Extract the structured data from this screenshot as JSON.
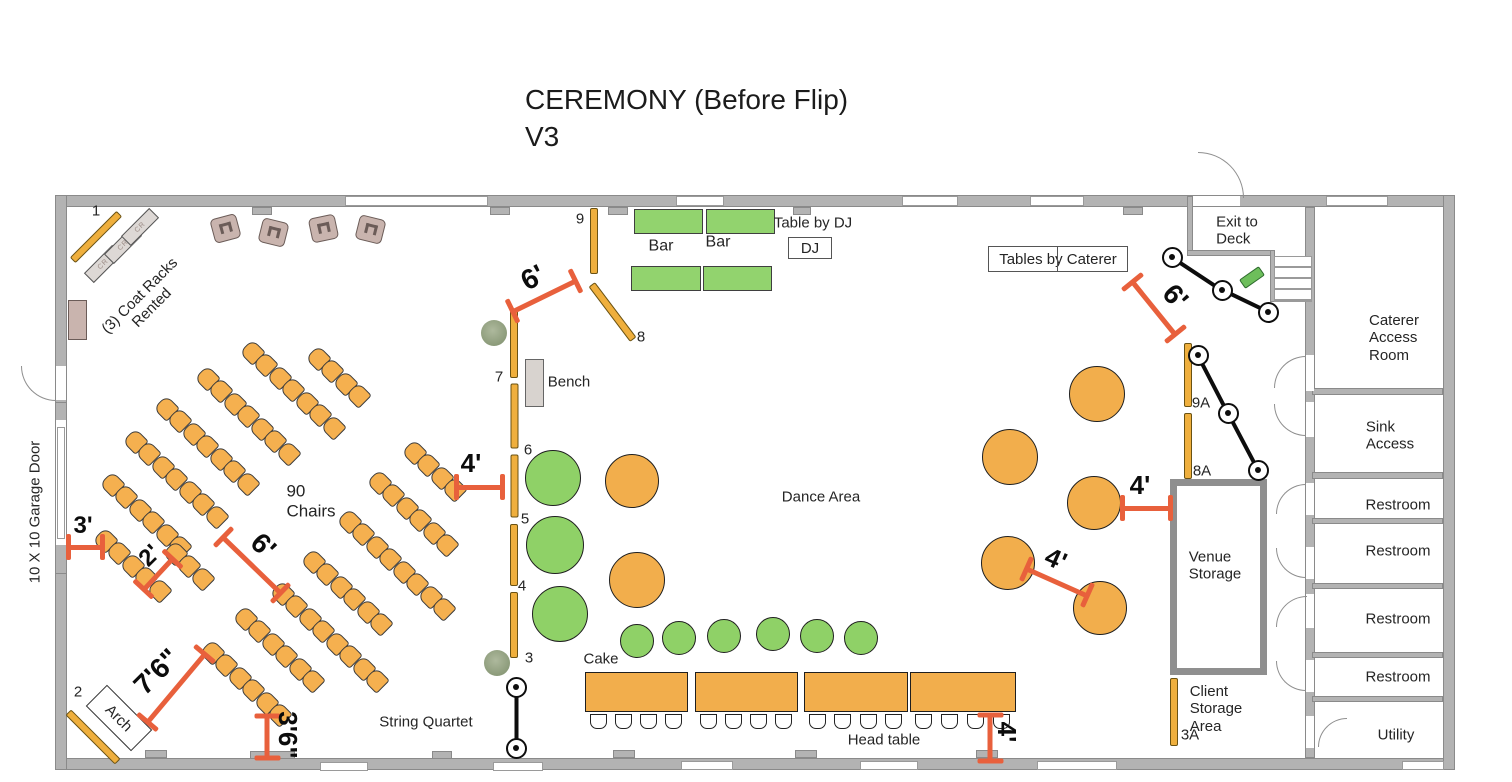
{
  "title": {
    "line1": "CEREMONY (Before Flip)",
    "line2": "V3"
  },
  "colors": {
    "dimension": "#E8603C",
    "chair": "#F5B04F",
    "table_orange": "#F2AE4C",
    "table_green": "#8FD167",
    "bar_green": "#92D36E",
    "gold_bar": "#EFAF3D",
    "wall": "#B3B3B3",
    "lounge": "#C9B4AE"
  },
  "building": {
    "walls": [
      [
        55,
        195,
        1400,
        12
      ],
      [
        55,
        758,
        1400,
        12
      ],
      [
        55,
        195,
        12,
        575
      ],
      [
        1443,
        195,
        12,
        575
      ],
      [
        1305,
        207,
        10,
        551
      ],
      [
        1312,
        388,
        131,
        7
      ],
      [
        1312,
        472,
        131,
        7
      ],
      [
        1312,
        518,
        131,
        6
      ],
      [
        1312,
        583,
        131,
        6
      ],
      [
        1312,
        652,
        131,
        6
      ],
      [
        1312,
        696,
        131,
        6
      ],
      [
        1187,
        196,
        6,
        60
      ],
      [
        1187,
        250,
        86,
        6
      ],
      [
        1270,
        250,
        5,
        52
      ]
    ],
    "gaps": [
      [
        1306,
        355,
        8,
        36
      ],
      [
        1306,
        402,
        8,
        35
      ],
      [
        1306,
        483,
        8,
        32
      ],
      [
        1306,
        547,
        8,
        32
      ],
      [
        1306,
        594,
        8,
        34
      ],
      [
        1306,
        660,
        8,
        32
      ],
      [
        1306,
        716,
        8,
        32
      ],
      [
        1193,
        196,
        47,
        10
      ],
      [
        56,
        366,
        10,
        34
      ],
      [
        56,
        420,
        10,
        125
      ]
    ],
    "pilasters": [
      [
        252,
        207,
        20,
        8
      ],
      [
        490,
        207,
        20,
        8
      ],
      [
        608,
        207,
        20,
        8
      ],
      [
        793,
        207,
        18,
        8
      ],
      [
        1123,
        207,
        20,
        8
      ],
      [
        145,
        750,
        22,
        8
      ],
      [
        432,
        751,
        20,
        8
      ],
      [
        613,
        750,
        22,
        8
      ],
      [
        795,
        750,
        22,
        8
      ],
      [
        976,
        750,
        22,
        8
      ],
      [
        250,
        751,
        45,
        8
      ],
      [
        55,
        402,
        12,
        22
      ],
      [
        55,
        540,
        12,
        34
      ]
    ],
    "windows": [
      [
        345,
        196,
        143,
        10
      ],
      [
        676,
        196,
        48,
        10
      ],
      [
        902,
        196,
        56,
        10
      ],
      [
        1030,
        196,
        54,
        10
      ],
      [
        1326,
        196,
        62,
        10
      ],
      [
        320,
        762,
        48,
        9
      ],
      [
        493,
        762,
        50,
        9
      ],
      [
        681,
        761,
        52,
        9
      ],
      [
        860,
        761,
        58,
        9
      ],
      [
        1037,
        761,
        80,
        9
      ],
      [
        1402,
        761,
        42,
        9
      ],
      [
        57,
        427,
        8,
        112
      ]
    ],
    "door_arcs": [
      {
        "x": 1274,
        "y": 356,
        "r": 32,
        "c": "tl"
      },
      {
        "x": 1274,
        "y": 404,
        "r": 32,
        "c": "bl"
      },
      {
        "x": 1276,
        "y": 484,
        "r": 30,
        "c": "tl"
      },
      {
        "x": 1276,
        "y": 548,
        "r": 30,
        "c": "bl"
      },
      {
        "x": 1276,
        "y": 596,
        "r": 31,
        "c": "tl"
      },
      {
        "x": 1276,
        "y": 661,
        "r": 30,
        "c": "bl"
      },
      {
        "x": 1318,
        "y": 718,
        "r": 29,
        "c": "tl"
      },
      {
        "x": 21,
        "y": 366,
        "r": 35,
        "c": "bl"
      },
      {
        "x": 1198,
        "y": 152,
        "r": 46,
        "c": "tr"
      }
    ],
    "stairs": {
      "x": 1274,
      "y": 256,
      "w": 38,
      "h": 46
    }
  },
  "furniture": {
    "green_tables": [
      [
        634,
        209,
        69,
        25
      ],
      [
        706,
        209,
        69,
        25
      ],
      [
        631,
        266,
        70,
        25
      ],
      [
        703,
        266,
        69,
        25
      ]
    ],
    "bench_rect": [
      525,
      359,
      19,
      48
    ],
    "side_table": [
      68,
      300,
      19,
      40
    ],
    "venue_storage_rect": [
      1170,
      479,
      97,
      196
    ],
    "dj_box": {
      "x": 788,
      "y": 237,
      "w": 44,
      "h": 22,
      "label": "DJ"
    },
    "caterer_box": {
      "x": 988,
      "y": 246,
      "w": 140,
      "h": 26,
      "label": "Tables by Caterer"
    },
    "arch_box": {
      "cx": 119,
      "cy": 718,
      "w": 64,
      "h": 30,
      "rot": 45,
      "label": "Arch"
    },
    "lounge_chairs": [
      [
        225,
        228,
        -15
      ],
      [
        273,
        232,
        14
      ],
      [
        323,
        228,
        -12
      ],
      [
        370,
        229,
        14
      ]
    ],
    "coat_racks": [
      [
        103,
        264
      ],
      [
        123,
        245
      ],
      [
        140,
        227
      ]
    ],
    "coat_rack_label": "CR",
    "plants": [
      [
        494,
        333
      ],
      [
        497,
        663
      ]
    ],
    "deck_item": [
      1252,
      277,
      -35
    ],
    "round_green_large": [
      [
        553,
        478,
        28
      ],
      [
        555,
        545,
        29
      ],
      [
        560,
        614,
        28
      ]
    ],
    "round_orange_mid": [
      [
        632,
        481,
        27
      ],
      [
        637,
        580,
        28
      ]
    ],
    "round_orange_right": [
      [
        1097,
        394,
        28
      ],
      [
        1010,
        457,
        28
      ],
      [
        1094,
        503,
        27
      ],
      [
        1008,
        563,
        27
      ],
      [
        1100,
        608,
        27
      ]
    ],
    "round_green_small": [
      [
        637,
        641,
        17
      ],
      [
        679,
        638,
        17
      ],
      [
        724,
        636,
        17
      ],
      [
        773,
        634,
        17
      ],
      [
        817,
        636,
        17
      ],
      [
        861,
        638,
        17
      ]
    ],
    "head_tables": [
      [
        585,
        672,
        103,
        40
      ],
      [
        695,
        672,
        103,
        40
      ],
      [
        804,
        672,
        104,
        40
      ],
      [
        910,
        672,
        106,
        40
      ]
    ],
    "stanchions": [
      [
        [
          1172,
          257
        ],
        [
          1222,
          290
        ],
        [
          1268,
          312
        ]
      ],
      [
        [
          1198,
          355
        ],
        [
          1228,
          413
        ],
        [
          1258,
          470
        ]
      ],
      [
        [
          516,
          687
        ],
        [
          516,
          748
        ]
      ]
    ],
    "chair_rows": [
      [
        252,
        352,
        7
      ],
      [
        318,
        358,
        4
      ],
      [
        207,
        378,
        7
      ],
      [
        166,
        408,
        7
      ],
      [
        135,
        441,
        7
      ],
      [
        112,
        484,
        6
      ],
      [
        105,
        540,
        5
      ],
      [
        175,
        553,
        3
      ],
      [
        245,
        618,
        6
      ],
      [
        212,
        652,
        6
      ],
      [
        282,
        593,
        8
      ],
      [
        313,
        561,
        6
      ],
      [
        349,
        521,
        8
      ],
      [
        379,
        482,
        6
      ],
      [
        414,
        452,
        4
      ]
    ],
    "gold_bars": [
      {
        "cx": 96,
        "cy": 237,
        "len": 66,
        "rot": -45
      },
      {
        "cx": 93,
        "cy": 737,
        "len": 70,
        "rot": 45
      },
      {
        "cx": 594,
        "cy": 241,
        "len": 66,
        "rot": 90
      },
      {
        "cx": 612,
        "cy": 312,
        "len": 69,
        "rot": 53
      },
      {
        "cx": 514,
        "cy": 344,
        "len": 68,
        "rot": 90
      },
      {
        "cx": 514,
        "cy": 416,
        "len": 65,
        "rot": 90
      },
      {
        "cx": 514,
        "cy": 486,
        "len": 63,
        "rot": 90
      },
      {
        "cx": 514,
        "cy": 555,
        "len": 62,
        "rot": 90
      },
      {
        "cx": 514,
        "cy": 625,
        "len": 66,
        "rot": 90
      },
      {
        "cx": 1188,
        "cy": 375,
        "len": 64,
        "rot": 90
      },
      {
        "cx": 1188,
        "cy": 446,
        "len": 66,
        "rot": 90
      },
      {
        "cx": 1174,
        "cy": 712,
        "len": 68,
        "rot": 90
      }
    ]
  },
  "dimensions": [
    {
      "n": "dim-3ft",
      "t": "3'",
      "cx": 85,
      "cy": 547,
      "len": 34,
      "rot": 0,
      "lx": 83,
      "ly": 526,
      "lrot": 0,
      "ls": 24
    },
    {
      "n": "dim-2ft",
      "t": "2'",
      "cx": 158,
      "cy": 574,
      "len": 42,
      "rot": -47,
      "lx": 150,
      "ly": 556,
      "lrot": -45,
      "ls": 24
    },
    {
      "n": "dim-6ft-aisle",
      "t": "6'",
      "cx": 252,
      "cy": 565,
      "len": 80,
      "rot": 44,
      "lx": 263,
      "ly": 546,
      "lrot": 44,
      "ls": 28
    },
    {
      "n": "dim-7ft6",
      "t": "7'6\"",
      "cx": 176,
      "cy": 688,
      "len": 88,
      "rot": -50,
      "lx": 157,
      "ly": 672,
      "lrot": -45,
      "ls": 28
    },
    {
      "n": "dim-3ft6",
      "t": "3'6\"",
      "cx": 267,
      "cy": 737,
      "len": 42,
      "rot": 90,
      "lx": 288,
      "ly": 735,
      "lrot": 90,
      "ls": 26
    },
    {
      "n": "dim-4ft-chairs",
      "t": "4'",
      "cx": 479,
      "cy": 487,
      "len": 46,
      "rot": 0,
      "lx": 471,
      "ly": 463,
      "lrot": 0,
      "ls": 26
    },
    {
      "n": "dim-6ft-bars",
      "t": "6'",
      "cx": 544,
      "cy": 296,
      "len": 70,
      "rot": -26,
      "lx": 533,
      "ly": 278,
      "lrot": -28,
      "ls": 28
    },
    {
      "n": "dim-6ft-deck",
      "t": "6'",
      "cx": 1154,
      "cy": 308,
      "len": 68,
      "rot": 51,
      "lx": 1175,
      "ly": 297,
      "lrot": 48,
      "ls": 28
    },
    {
      "n": "dim-4ft-storage",
      "t": "4'",
      "cx": 1146,
      "cy": 508,
      "len": 48,
      "rot": 0,
      "lx": 1140,
      "ly": 485,
      "lrot": 0,
      "ls": 26
    },
    {
      "n": "dim-4ft-tables",
      "t": "4'",
      "cx": 1057,
      "cy": 582,
      "len": 66,
      "rot": 24,
      "lx": 1056,
      "ly": 559,
      "lrot": 24,
      "ls": 26
    },
    {
      "n": "dim-4ft-headtable",
      "t": "4'",
      "cx": 990,
      "cy": 738,
      "len": 46,
      "rot": 90,
      "lx": 1007,
      "ly": 732,
      "lrot": 90,
      "ls": 26
    }
  ],
  "labels": [
    {
      "n": "marker-1",
      "t": "1",
      "x": 96,
      "y": 211,
      "s": 15
    },
    {
      "n": "marker-2",
      "t": "2",
      "x": 78,
      "y": 692,
      "s": 15
    },
    {
      "n": "marker-9",
      "t": "9",
      "x": 580,
      "y": 219,
      "s": 15
    },
    {
      "n": "marker-8",
      "t": "8",
      "x": 641,
      "y": 337,
      "s": 15
    },
    {
      "n": "marker-7",
      "t": "7",
      "x": 499,
      "y": 377,
      "s": 15
    },
    {
      "n": "marker-6",
      "t": "6",
      "x": 528,
      "y": 450,
      "s": 15
    },
    {
      "n": "marker-5",
      "t": "5",
      "x": 525,
      "y": 519,
      "s": 15
    },
    {
      "n": "marker-4",
      "t": "4",
      "x": 522,
      "y": 586,
      "s": 15
    },
    {
      "n": "marker-3",
      "t": "3",
      "x": 529,
      "y": 658,
      "s": 15
    },
    {
      "n": "marker-9a",
      "t": "9A",
      "x": 1201,
      "y": 403,
      "s": 15
    },
    {
      "n": "marker-8a",
      "t": "8A",
      "x": 1202,
      "y": 471,
      "s": 15
    },
    {
      "n": "marker-3a",
      "t": "3A",
      "x": 1190,
      "y": 735,
      "s": 15
    },
    {
      "n": "coat-racks-note",
      "t": "(3) Coat Racks\nRented",
      "x": 146,
      "y": 302,
      "s": 15,
      "rot": -45
    },
    {
      "n": "bar-label-1",
      "t": "Bar",
      "x": 661,
      "y": 247,
      "s": 16
    },
    {
      "n": "bar-label-2",
      "t": "Bar",
      "x": 718,
      "y": 243,
      "s": 16
    },
    {
      "n": "table-by-dj-label",
      "t": "Table by DJ",
      "x": 813,
      "y": 223,
      "s": 15
    },
    {
      "n": "exit-to-deck-label",
      "t": "Exit to\nDeck",
      "x": 1237,
      "y": 231,
      "s": 15,
      "align": "left"
    },
    {
      "n": "caterer-access-room-label",
      "t": "Caterer\nAccess\nRoom",
      "x": 1394,
      "y": 338,
      "s": 15,
      "align": "left"
    },
    {
      "n": "sink-access-label",
      "t": "Sink\nAccess",
      "x": 1390,
      "y": 436,
      "s": 15,
      "align": "left"
    },
    {
      "n": "restroom-label-1",
      "t": "Restroom",
      "x": 1398,
      "y": 505,
      "s": 15
    },
    {
      "n": "restroom-label-2",
      "t": "Restroom",
      "x": 1398,
      "y": 551,
      "s": 15
    },
    {
      "n": "restroom-label-3",
      "t": "Restroom",
      "x": 1398,
      "y": 619,
      "s": 15
    },
    {
      "n": "restroom-label-4",
      "t": "Restroom",
      "x": 1398,
      "y": 677,
      "s": 15
    },
    {
      "n": "utility-label",
      "t": "Utility",
      "x": 1396,
      "y": 735,
      "s": 15
    },
    {
      "n": "venue-storage-label",
      "t": "Venue\nStorage",
      "x": 1215,
      "y": 566,
      "s": 15,
      "align": "left"
    },
    {
      "n": "client-storage-label",
      "t": "Client\nStorage\nArea",
      "x": 1216,
      "y": 709,
      "s": 15,
      "align": "left"
    },
    {
      "n": "dance-area-label",
      "t": "Dance Area",
      "x": 821,
      "y": 497,
      "s": 15
    },
    {
      "n": "chair-count-label",
      "t": "90\nChairs",
      "x": 311,
      "y": 501,
      "s": 17,
      "align": "left"
    },
    {
      "n": "bench-label",
      "t": "Bench",
      "x": 569,
      "y": 382,
      "s": 15
    },
    {
      "n": "cake-label",
      "t": "Cake",
      "x": 601,
      "y": 659,
      "s": 15
    },
    {
      "n": "head-table-label",
      "t": "Head table",
      "x": 884,
      "y": 740,
      "s": 15
    },
    {
      "n": "string-quartet-label",
      "t": "String Quartet",
      "x": 426,
      "y": 722,
      "s": 15
    },
    {
      "n": "garage-door-label",
      "t": "10 X 10 Garage Door",
      "x": 35,
      "y": 512,
      "s": 15,
      "rot": -90
    }
  ]
}
